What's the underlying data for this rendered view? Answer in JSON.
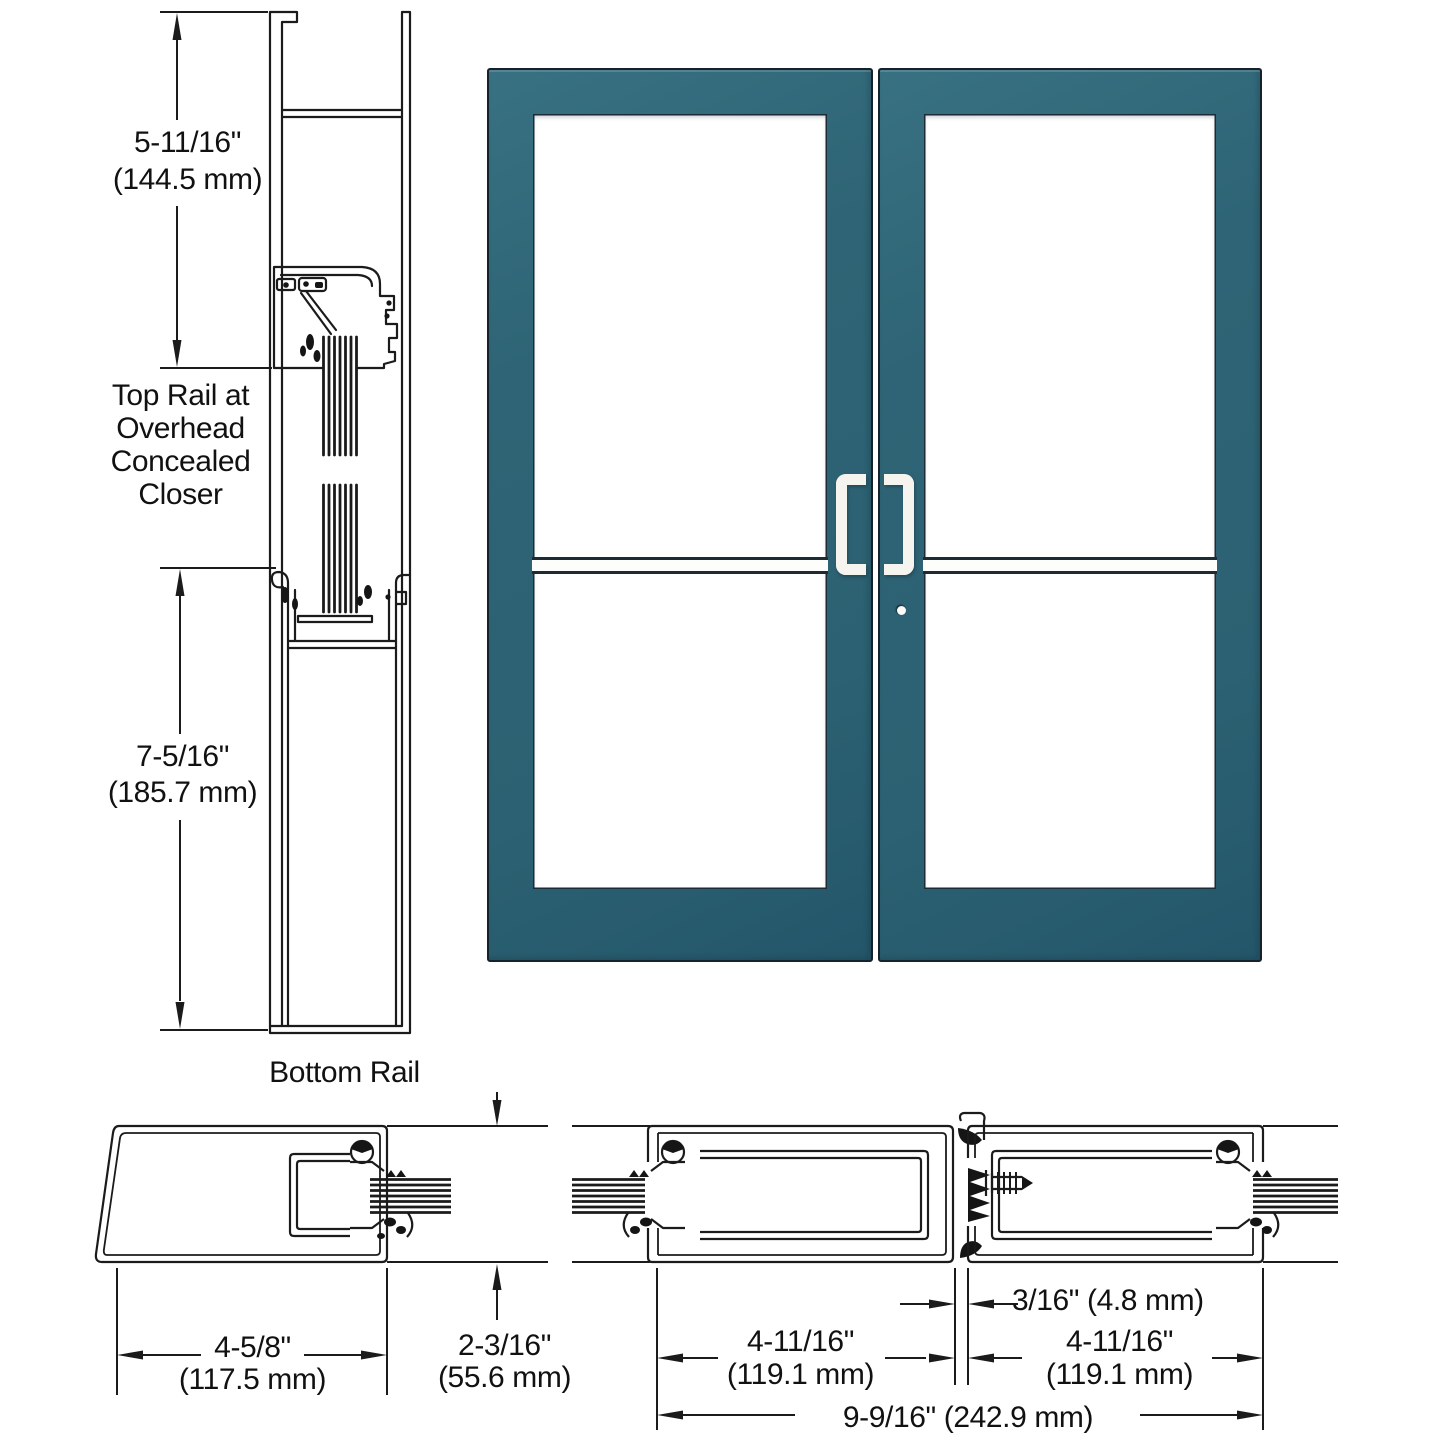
{
  "colors": {
    "door_teal": "#2e6475",
    "door_teal_dark": "#24566a",
    "door_outline": "#15222c",
    "handle_white": "#f6f4ee",
    "line_art": "#1b1b1b",
    "glass_white": "#ffffff"
  },
  "vertical_section": {
    "top_rail_dim": {
      "inches": "5-11/16\"",
      "mm": "(144.5 mm)"
    },
    "top_rail_caption": [
      "Top Rail at",
      "Overhead",
      "Concealed",
      "Closer"
    ],
    "bottom_rail_dim": {
      "inches": "7-5/16\"",
      "mm": "(185.7 mm)"
    },
    "bottom_rail_caption": "Bottom Rail"
  },
  "plan_section": {
    "jamb_width": {
      "inches": "4-5/8\"",
      "mm": "(117.5 mm)"
    },
    "rail_depth": {
      "inches": "2-3/16\"",
      "mm": "(55.6 mm)"
    },
    "left_stile_width": {
      "inches": "4-11/16\"",
      "mm": "(119.1 mm)"
    },
    "meeting_gap": "3/16\" (4.8 mm)",
    "right_stile_width": {
      "inches": "4-11/16\"",
      "mm": "(119.1 mm)"
    },
    "overall_width": "9-9/16\" (242.9 mm)"
  }
}
